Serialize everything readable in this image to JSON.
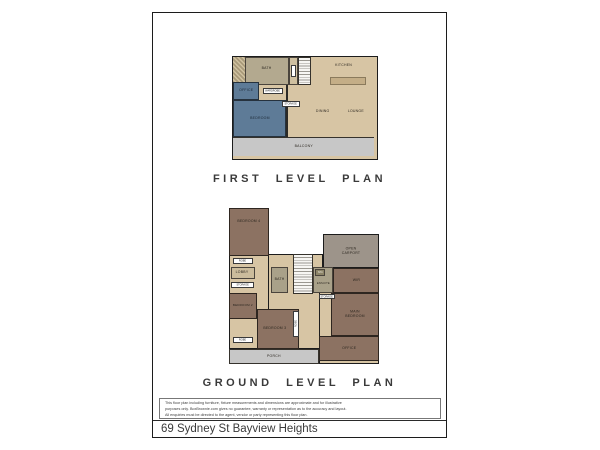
{
  "address_bar": {
    "address": "69 Sydney St Bayview Heights"
  },
  "first_plan": {
    "title": "FIRST LEVEL PLAN",
    "labels": {
      "bath": "BATH",
      "kitchen": "KITCHEN",
      "office": "OFFICE",
      "bedroom": "BEDROOM",
      "dining": "DINING",
      "lounge": "LOUNGE",
      "balcony": "BALCONY",
      "wardrobe": "WARDROBE",
      "storage": "STORAGE"
    }
  },
  "ground_plan": {
    "title": "GROUND LEVEL PLAN",
    "labels": {
      "bedroom4": "BEDROOM 4",
      "robe4": "ROBE",
      "lobby": "LOBBY",
      "storage_lobby": "STORAGE",
      "open_carport": "OPEN CARPORT",
      "bath": "BATH",
      "spa": "SPA",
      "ensuite": "ENSUITE",
      "wir": "WIR",
      "storage_mid": "STORAGE",
      "main_bedroom": "MAIN BEDROOM",
      "bedroom2": "BEDROOM 2",
      "bedroom3": "BEDROOM 3",
      "robe3": "ROBE",
      "robe2": "ROBE",
      "office": "OFFICE",
      "porch": "PORCH"
    }
  },
  "disclaimer": {
    "line1": "This floor plan including furniture, fixture measurements and dimensions are approximate and for illustrative",
    "line2": "purposes only. BoxBrownie.com gives no guarantee, warranty or representation as to the accuracy and layout.",
    "line3": "All enquiries must be directed to the agent, vendor or party representing this floor plan."
  },
  "colors": {
    "wall": "#1c1c1c",
    "floor_beige": "#d7c5a4",
    "room_blue": "#5e7b97",
    "room_brown": "#8c7262",
    "bath_khaki": "#aea68c",
    "carport_gray": "#9d948a",
    "outdoor_gray": "#c7c7c7",
    "island_tan": "#c4ae87"
  }
}
